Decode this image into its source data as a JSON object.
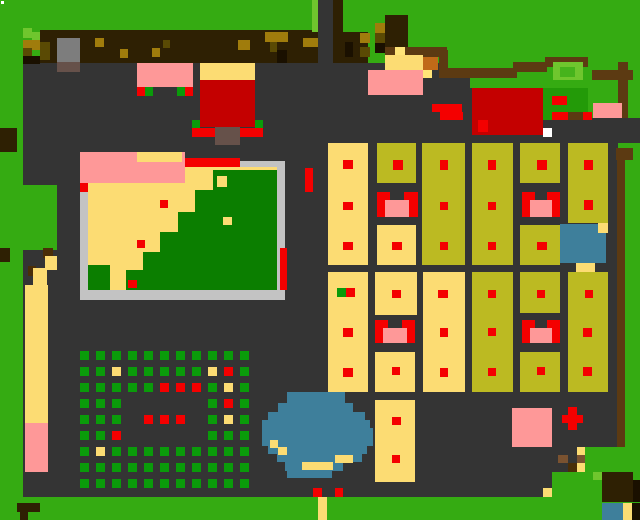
{
  "map": {
    "width": 640,
    "height": 520,
    "background_color": "#35ab12"
  },
  "palette": {
    "bg": "#35ab12",
    "lg": "#6fc62e",
    "bg2": "#46b31c",
    "dg": "#0b7e00",
    "mg": "#239a08",
    "cg": "#0a9b0a",
    "gy": "#343434",
    "bd": "#c3c3c3",
    "st": "#7d7d7d",
    "sb": "#66514a",
    "tn": "#fcdc73",
    "yl": "#ffe478",
    "kh": "#bcba22",
    "rd": "#f40000",
    "rr": "#c40000",
    "pk": "#fe9898",
    "tl": "#3e7f9b",
    "fb": "#2e2003",
    "go": "#a07c0c",
    "ol": "#5a4a04",
    "or": "#c06a18",
    "sd": "#5c3a12",
    "bk": "#1a1000",
    "rb": "#7a5230",
    "db": "#4a2e08",
    "wh": "#ffffff"
  },
  "rects": [
    [
      23,
      63,
      595,
      434,
      "gy",
      "ground"
    ],
    [
      443,
      63,
      175,
      25,
      "bg",
      "grass-top-right"
    ],
    [
      543,
      88,
      97,
      30,
      "bg",
      "grass-right"
    ],
    [
      543,
      88,
      45,
      32,
      "mg",
      "dark-grass-patch"
    ],
    [
      318,
      0,
      16,
      64,
      "gy",
      "path-top"
    ],
    [
      23,
      185,
      34,
      65,
      "bg",
      "grass-bulge-left"
    ],
    [
      0,
      497,
      640,
      23,
      "bg",
      "grass-bottom-band"
    ],
    [
      585,
      447,
      33,
      25,
      "bg",
      "grass-bottom-right"
    ],
    [
      552,
      472,
      66,
      25,
      "bg",
      "grass-bottom-right-2"
    ],
    [
      593,
      118,
      47,
      25,
      "gy",
      "ground-right-edge"
    ],
    [
      40,
      30,
      278,
      33,
      "fb",
      "fence-band"
    ],
    [
      333,
      0,
      10,
      63,
      "fb",
      "fence-path-edge"
    ],
    [
      334,
      32,
      34,
      31,
      "fb",
      "fence-band-2"
    ],
    [
      312,
      0,
      6,
      32,
      "lg",
      "path-grass-edge"
    ],
    [
      95,
      38,
      9,
      9,
      "go",
      "fence-knot"
    ],
    [
      120,
      49,
      8,
      9,
      "go",
      "fence-knot"
    ],
    [
      152,
      48,
      8,
      9,
      "go",
      "fence-knot"
    ],
    [
      163,
      40,
      7,
      8,
      "ol",
      "fence-knot"
    ],
    [
      238,
      40,
      12,
      10,
      "go",
      "fence-knot"
    ],
    [
      265,
      32,
      23,
      10,
      "go",
      "fence-knot"
    ],
    [
      270,
      42,
      7,
      10,
      "ol",
      "fence-knot"
    ],
    [
      277,
      50,
      10,
      13,
      "bk",
      "fence-knot"
    ],
    [
      303,
      38,
      15,
      9,
      "go",
      "fence-knot"
    ],
    [
      345,
      42,
      8,
      15,
      "bk",
      "fence-knot"
    ],
    [
      23,
      28,
      9,
      10,
      "lg",
      "grass-tuft"
    ],
    [
      32,
      32,
      8,
      8,
      "lg",
      "grass-tuft"
    ],
    [
      23,
      40,
      17,
      8,
      "go",
      "corner-dirt"
    ],
    [
      32,
      40,
      8,
      10,
      "go",
      "corner-dirt"
    ],
    [
      40,
      42,
      10,
      18,
      "ol",
      "corner-dirt"
    ],
    [
      23,
      48,
      9,
      8,
      "ol",
      "corner-dirt"
    ],
    [
      23,
      56,
      17,
      8,
      "bk",
      "corner-dirt"
    ],
    [
      0,
      128,
      17,
      24,
      "fb",
      "tree-left-edge"
    ],
    [
      57,
      38,
      23,
      24,
      "st",
      "stone-statue"
    ],
    [
      57,
      62,
      23,
      10,
      "sb",
      "stone-base"
    ],
    [
      1,
      1,
      3,
      3,
      "wh",
      "cursor-pixel"
    ],
    [
      385,
      15,
      23,
      33,
      "fb",
      "tree-top"
    ],
    [
      375,
      23,
      10,
      10,
      "go",
      "tree-detail"
    ],
    [
      375,
      33,
      10,
      10,
      "ol",
      "tree-detail"
    ],
    [
      375,
      43,
      10,
      10,
      "bk",
      "tree-detail"
    ],
    [
      360,
      33,
      10,
      10,
      "go",
      "tree-detail"
    ],
    [
      360,
      47,
      10,
      10,
      "ol",
      "tree-detail"
    ],
    [
      385,
      47,
      62,
      10,
      "sd",
      "fence-bar"
    ],
    [
      395,
      47,
      10,
      10,
      "yl",
      "fence-light"
    ],
    [
      439,
      50,
      9,
      28,
      "sd",
      "fence-post"
    ],
    [
      385,
      55,
      38,
      16,
      "tn",
      "sand-patch-top"
    ],
    [
      423,
      57,
      15,
      13,
      "or",
      "crate"
    ],
    [
      423,
      70,
      9,
      8,
      "yl",
      "crate-light"
    ],
    [
      368,
      70,
      55,
      25,
      "pk",
      "pink-roof-small"
    ],
    [
      432,
      78,
      38,
      17,
      "gy",
      "ground-blob-top"
    ],
    [
      368,
      95,
      102,
      48,
      "gy",
      "ground-blob"
    ],
    [
      432,
      104,
      30,
      8,
      "rd",
      "red-mark"
    ],
    [
      440,
      112,
      23,
      8,
      "rd",
      "red-mark"
    ],
    [
      447,
      68,
      70,
      10,
      "sd",
      "fence-bar"
    ],
    [
      513,
      62,
      34,
      10,
      "sd",
      "fence-bar"
    ],
    [
      545,
      57,
      43,
      10,
      "sd",
      "fence-bar"
    ],
    [
      592,
      70,
      41,
      10,
      "sd",
      "fence-bar"
    ],
    [
      618,
      62,
      10,
      56,
      "sd",
      "fence-post-right"
    ],
    [
      553,
      62,
      30,
      18,
      "lg",
      "bush"
    ],
    [
      560,
      67,
      15,
      10,
      "bg2",
      "bush-inner"
    ],
    [
      552,
      96,
      15,
      9,
      "rd",
      "red-mark"
    ],
    [
      552,
      112,
      16,
      8,
      "rd",
      "red-mark"
    ],
    [
      568,
      112,
      15,
      8,
      "sd",
      "dirt-mark"
    ],
    [
      583,
      112,
      9,
      8,
      "rd",
      "red-mark"
    ],
    [
      593,
      103,
      29,
      15,
      "pk",
      "pink-patch"
    ],
    [
      472,
      88,
      71,
      47,
      "rr",
      "building-roof-red"
    ],
    [
      478,
      120,
      10,
      12,
      "rd",
      "door-marker"
    ],
    [
      543,
      128,
      9,
      9,
      "wh",
      "white-sign"
    ],
    [
      616,
      148,
      17,
      12,
      "sd",
      "fence-gate"
    ],
    [
      617,
      160,
      8,
      287,
      "sd",
      "fence-right"
    ],
    [
      137,
      63,
      56,
      24,
      "pk",
      "building-roof-pink"
    ],
    [
      137,
      87,
      8,
      9,
      "rd",
      "door-marker"
    ],
    [
      145,
      87,
      8,
      9,
      "cg",
      "bush-marker"
    ],
    [
      177,
      87,
      8,
      9,
      "cg",
      "bush-marker"
    ],
    [
      185,
      87,
      8,
      9,
      "rd",
      "door-marker"
    ],
    [
      200,
      63,
      55,
      17,
      "tn",
      "building-awning"
    ],
    [
      200,
      80,
      55,
      47,
      "rr",
      "building-roof-red"
    ],
    [
      192,
      120,
      8,
      8,
      "cg",
      "bush-marker"
    ],
    [
      255,
      120,
      8,
      8,
      "cg",
      "bush-marker"
    ],
    [
      192,
      128,
      71,
      9,
      "rd",
      "building-step"
    ],
    [
      215,
      127,
      25,
      18,
      "sb",
      "building-porch"
    ],
    [
      80,
      152,
      105,
      31,
      "pk",
      "park-roof-pink"
    ],
    [
      137,
      152,
      45,
      10,
      "tn",
      "park-roof-tan"
    ],
    [
      185,
      158,
      55,
      10,
      "rd",
      "park-border-red"
    ],
    [
      240,
      161,
      45,
      9,
      "bd",
      "park-border"
    ],
    [
      185,
      167,
      92,
      16,
      "tn",
      "park-sand"
    ],
    [
      88,
      183,
      189,
      107,
      "tn",
      "park-sand"
    ],
    [
      80,
      183,
      8,
      110,
      "bd",
      "park-border"
    ],
    [
      80,
      183,
      8,
      9,
      "rd",
      "park-corner-red"
    ],
    [
      277,
      170,
      8,
      125,
      "bd",
      "park-border"
    ],
    [
      80,
      290,
      205,
      10,
      "bd",
      "park-border"
    ],
    [
      280,
      248,
      7,
      42,
      "rd",
      "park-border-red"
    ],
    [
      213,
      170,
      64,
      120,
      "dg",
      "park-field"
    ],
    [
      195,
      190,
      20,
      100,
      "dg",
      "park-field"
    ],
    [
      178,
      212,
      17,
      78,
      "dg",
      "park-field"
    ],
    [
      160,
      232,
      18,
      58,
      "dg",
      "park-field"
    ],
    [
      143,
      252,
      17,
      38,
      "dg",
      "park-field"
    ],
    [
      126,
      270,
      17,
      20,
      "dg",
      "park-field"
    ],
    [
      88,
      265,
      22,
      25,
      "dg",
      "park-field"
    ],
    [
      217,
      176,
      10,
      11,
      "tn",
      "sand-patch"
    ],
    [
      223,
      217,
      9,
      8,
      "tn",
      "sand-patch"
    ],
    [
      160,
      200,
      8,
      8,
      "rd",
      "item-marker"
    ],
    [
      137,
      240,
      8,
      8,
      "rd",
      "item-marker"
    ],
    [
      128,
      280,
      9,
      8,
      "rd",
      "item-marker"
    ],
    [
      305,
      168,
      8,
      24,
      "rd",
      "red-post"
    ],
    [
      43,
      248,
      10,
      10,
      "db",
      "dirt-path"
    ],
    [
      50,
      258,
      7,
      12,
      "rb",
      "dirt-path"
    ],
    [
      28,
      266,
      8,
      10,
      "db",
      "dirt-path"
    ],
    [
      45,
      256,
      12,
      14,
      "tn",
      "sand-path"
    ],
    [
      33,
      268,
      14,
      24,
      "tn",
      "sand-path"
    ],
    [
      25,
      285,
      23,
      20,
      "tn",
      "sand-path"
    ],
    [
      25,
      300,
      23,
      123,
      "tn",
      "sand-road"
    ],
    [
      25,
      423,
      23,
      49,
      "pk",
      "pink-road-end"
    ],
    [
      0,
      248,
      10,
      14,
      "fb",
      "tree-left-edge"
    ],
    [
      17,
      503,
      23,
      9,
      "fb",
      "tree-bottom-left"
    ],
    [
      20,
      510,
      8,
      10,
      "fb",
      "tree-bottom-left"
    ],
    [
      328,
      143,
      40,
      122,
      "tn",
      "building-tan"
    ],
    [
      343,
      160,
      10,
      9,
      "rd",
      "door-marker"
    ],
    [
      343,
      202,
      10,
      8,
      "rd",
      "door-marker"
    ],
    [
      343,
      242,
      10,
      8,
      "rd",
      "door-marker"
    ],
    [
      377,
      143,
      39,
      40,
      "kh",
      "building-khaki"
    ],
    [
      393,
      160,
      10,
      10,
      "rd",
      "door-marker"
    ],
    [
      422,
      143,
      43,
      122,
      "kh",
      "building-khaki"
    ],
    [
      440,
      160,
      8,
      10,
      "rd",
      "door-marker"
    ],
    [
      440,
      202,
      8,
      8,
      "rd",
      "door-marker"
    ],
    [
      440,
      242,
      8,
      8,
      "rd",
      "door-marker"
    ],
    [
      472,
      143,
      41,
      122,
      "kh",
      "building-khaki"
    ],
    [
      488,
      160,
      8,
      10,
      "rd",
      "door-marker"
    ],
    [
      488,
      202,
      8,
      8,
      "rd",
      "door-marker"
    ],
    [
      488,
      242,
      8,
      8,
      "rd",
      "door-marker"
    ],
    [
      520,
      143,
      40,
      40,
      "kh",
      "building-khaki"
    ],
    [
      537,
      160,
      10,
      10,
      "rd",
      "door-marker"
    ],
    [
      568,
      143,
      40,
      80,
      "kh",
      "building-khaki"
    ],
    [
      584,
      160,
      9,
      10,
      "rd",
      "door-marker"
    ],
    [
      584,
      200,
      9,
      10,
      "rd",
      "door-marker"
    ],
    [
      377,
      192,
      8,
      25,
      "rd",
      "gate-pillar"
    ],
    [
      409,
      192,
      9,
      25,
      "rd",
      "gate-pillar"
    ],
    [
      385,
      192,
      5,
      8,
      "rd",
      "gate-top"
    ],
    [
      404,
      192,
      5,
      8,
      "rd",
      "gate-top"
    ],
    [
      385,
      200,
      24,
      17,
      "pk",
      "gate-pink"
    ],
    [
      522,
      192,
      8,
      25,
      "rd",
      "gate-pillar"
    ],
    [
      552,
      192,
      8,
      25,
      "rd",
      "gate-pillar"
    ],
    [
      530,
      192,
      5,
      8,
      "rd",
      "gate-top"
    ],
    [
      547,
      192,
      5,
      8,
      "rd",
      "gate-top"
    ],
    [
      530,
      200,
      22,
      17,
      "pk",
      "gate-pink"
    ],
    [
      377,
      225,
      39,
      40,
      "tn",
      "building-tan"
    ],
    [
      392,
      242,
      10,
      8,
      "rd",
      "door-marker"
    ],
    [
      520,
      225,
      40,
      40,
      "kh",
      "building-khaki"
    ],
    [
      537,
      242,
      10,
      8,
      "rd",
      "door-marker"
    ],
    [
      560,
      224,
      46,
      39,
      "tl",
      "pond-small"
    ],
    [
      598,
      223,
      10,
      10,
      "tn",
      "pond-sand"
    ],
    [
      576,
      263,
      19,
      9,
      "tn",
      "pond-sand"
    ],
    [
      328,
      272,
      40,
      120,
      "tn",
      "building-tan"
    ],
    [
      337,
      288,
      9,
      9,
      "cg",
      "bush-marker"
    ],
    [
      346,
      288,
      9,
      9,
      "rd",
      "door-marker"
    ],
    [
      343,
      328,
      10,
      9,
      "rd",
      "door-marker"
    ],
    [
      343,
      368,
      10,
      9,
      "rd",
      "door-marker"
    ],
    [
      375,
      272,
      42,
      43,
      "tn",
      "building-tan"
    ],
    [
      392,
      290,
      9,
      8,
      "rd",
      "door-marker"
    ],
    [
      423,
      272,
      42,
      120,
      "tn",
      "building-tan"
    ],
    [
      438,
      290,
      10,
      8,
      "rd",
      "door-marker"
    ],
    [
      440,
      328,
      8,
      9,
      "rd",
      "door-marker"
    ],
    [
      440,
      368,
      8,
      9,
      "rd",
      "door-marker"
    ],
    [
      472,
      272,
      41,
      120,
      "kh",
      "building-khaki"
    ],
    [
      488,
      290,
      8,
      8,
      "rd",
      "door-marker"
    ],
    [
      488,
      328,
      8,
      8,
      "rd",
      "door-marker"
    ],
    [
      488,
      368,
      8,
      8,
      "rd",
      "door-marker"
    ],
    [
      520,
      272,
      40,
      41,
      "kh",
      "building-khaki"
    ],
    [
      537,
      290,
      8,
      8,
      "rd",
      "door-marker"
    ],
    [
      568,
      272,
      40,
      120,
      "kh",
      "building-khaki"
    ],
    [
      585,
      290,
      8,
      8,
      "rd",
      "door-marker"
    ],
    [
      583,
      328,
      9,
      9,
      "rd",
      "door-marker"
    ],
    [
      583,
      367,
      9,
      9,
      "rd",
      "door-marker"
    ],
    [
      375,
      320,
      8,
      23,
      "rd",
      "gate-pillar"
    ],
    [
      407,
      320,
      8,
      23,
      "rd",
      "gate-pillar"
    ],
    [
      383,
      320,
      5,
      8,
      "rd",
      "gate-top"
    ],
    [
      402,
      320,
      5,
      8,
      "rd",
      "gate-top"
    ],
    [
      383,
      328,
      24,
      15,
      "pk",
      "gate-pink"
    ],
    [
      522,
      320,
      8,
      23,
      "rd",
      "gate-pillar"
    ],
    [
      552,
      320,
      8,
      23,
      "rd",
      "gate-pillar"
    ],
    [
      530,
      320,
      5,
      8,
      "rd",
      "gate-top"
    ],
    [
      547,
      320,
      5,
      8,
      "rd",
      "gate-top"
    ],
    [
      530,
      328,
      22,
      15,
      "pk",
      "gate-pink"
    ],
    [
      375,
      352,
      40,
      40,
      "tn",
      "building-tan"
    ],
    [
      392,
      367,
      8,
      8,
      "rd",
      "door-marker"
    ],
    [
      520,
      352,
      40,
      40,
      "kh",
      "building-khaki"
    ],
    [
      537,
      367,
      8,
      8,
      "rd",
      "door-marker"
    ],
    [
      375,
      400,
      40,
      82,
      "tn",
      "building-tan"
    ],
    [
      392,
      417,
      9,
      8,
      "rd",
      "door-marker"
    ],
    [
      392,
      455,
      8,
      8,
      "rd",
      "door-marker"
    ],
    [
      287,
      392,
      58,
      11,
      "tl",
      "pond-big"
    ],
    [
      278,
      403,
      75,
      9,
      "tl",
      "pond-big"
    ],
    [
      268,
      412,
      97,
      8,
      "tl",
      "pond-big"
    ],
    [
      262,
      420,
      108,
      8,
      "tl",
      "pond-big"
    ],
    [
      262,
      428,
      111,
      18,
      "tl",
      "pond-big"
    ],
    [
      268,
      446,
      99,
      8,
      "tl",
      "pond-big"
    ],
    [
      277,
      454,
      85,
      8,
      "tl",
      "pond-big"
    ],
    [
      285,
      462,
      58,
      9,
      "tl",
      "pond-big"
    ],
    [
      287,
      470,
      45,
      8,
      "tl",
      "pond-big"
    ],
    [
      270,
      440,
      8,
      8,
      "tn",
      "pond-sand"
    ],
    [
      278,
      447,
      9,
      8,
      "tn",
      "pond-sand"
    ],
    [
      335,
      455,
      18,
      8,
      "tn",
      "pond-sand"
    ],
    [
      302,
      462,
      31,
      8,
      "tn",
      "pond-sand"
    ],
    [
      313,
      488,
      9,
      9,
      "rd",
      "door-marker"
    ],
    [
      335,
      488,
      8,
      9,
      "rd",
      "door-marker"
    ],
    [
      318,
      497,
      9,
      23,
      "tn",
      "sand-exit-path"
    ],
    [
      543,
      488,
      9,
      9,
      "tn",
      "sand-dot"
    ],
    [
      558,
      455,
      10,
      8,
      "rb",
      "dirt-path"
    ],
    [
      577,
      447,
      8,
      8,
      "tn",
      "sand-path"
    ],
    [
      577,
      455,
      8,
      8,
      "rb",
      "dirt-path"
    ],
    [
      568,
      463,
      9,
      9,
      "db",
      "dirt-path"
    ],
    [
      577,
      463,
      8,
      9,
      "tn",
      "sand-path"
    ],
    [
      512,
      408,
      40,
      39,
      "pk",
      "building-pink"
    ],
    [
      568,
      407,
      9,
      23,
      "rd",
      "red-cross"
    ],
    [
      562,
      415,
      21,
      8,
      "rd",
      "red-cross"
    ],
    [
      602,
      472,
      31,
      30,
      "fb",
      "tree-bottom-right"
    ],
    [
      633,
      480,
      7,
      22,
      "bk",
      "tree-shadow"
    ],
    [
      593,
      472,
      9,
      8,
      "lg",
      "grass-tuft"
    ],
    [
      602,
      503,
      21,
      17,
      "tl",
      "pond-corner"
    ],
    [
      623,
      503,
      9,
      17,
      "tn",
      "pond-sand"
    ],
    [
      632,
      503,
      8,
      17,
      "bk",
      "tree-shadow"
    ]
  ],
  "crop_field": {
    "x": 80,
    "y": 351,
    "pitch": 16,
    "dot": 9,
    "colors": {
      "G": "cg",
      "T": "tn",
      "R": "rd"
    },
    "rows": [
      "GGGGGGGGGGG",
      "GGTGGGGGTRG",
      "GGGGGRRRGTG",
      "GGG.....GRG",
      "GGG.RRR.GTG",
      "GGR.....GGG",
      "GTGGGGGGGGG",
      "GGGGGGGGGGG",
      "GGGGGGGGGGG"
    ]
  }
}
